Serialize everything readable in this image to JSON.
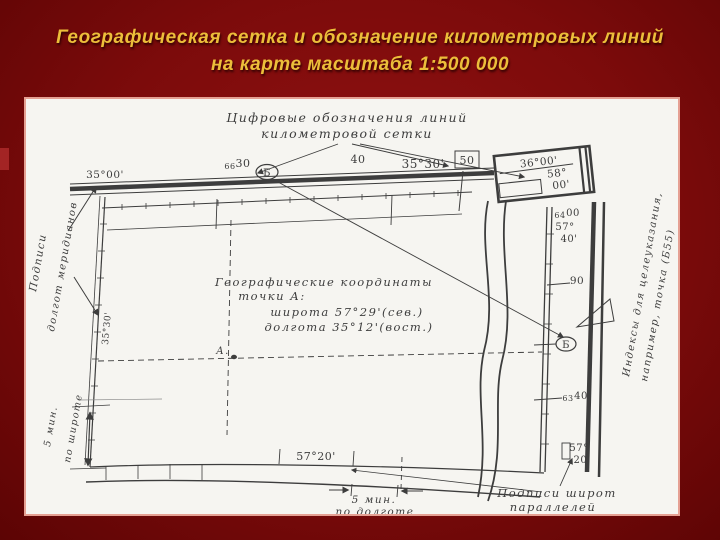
{
  "slide": {
    "title": {
      "line1": "Географическая сетка и обозначение километровых линий",
      "line2": "на карте масштаба 1:500 000"
    },
    "colors": {
      "background": "#7c0b0b",
      "title_text": "#ecbe3a",
      "panel_paper": "#f6f5f1",
      "panel_border": "#e5a093",
      "ink": "#3d3d3d"
    }
  },
  "diagram": {
    "top_caption": {
      "line1": "Цифровые обозначения линий",
      "line2": "километровой сетки"
    },
    "top_frame": {
      "corner_nw": "35°00'",
      "km_full_prefix": "66",
      "km_full": "30",
      "oval_letter": "Б",
      "km_40": "40",
      "meridian_mid": "35°30'",
      "km_50": "50"
    },
    "corner_ne": {
      "lon": "36°00'",
      "lat_deg": "58°",
      "lat_min": "00'"
    },
    "left_side": {
      "caption_line1": "Подписи",
      "caption_line2": "долгот меридианов",
      "meridian_vertical": "35°30'"
    },
    "coords_note": {
      "line1": "Географические координаты",
      "line2": "точки А:",
      "line3": "широта 57°29'(сев.)",
      "line4": "долгота 35°12'(вост.)"
    },
    "point_a": "А.",
    "right_side": {
      "km_6400_prefix": "64",
      "km_6400": "00",
      "lat_40_deg": "57°",
      "lat_40_min": "40'",
      "km_90": "90",
      "oval_letter": "Б",
      "km_6340_prefix": "63",
      "km_6340": "40",
      "lat_20_deg": "57°",
      "lat_20_min": "20'",
      "caption_line1": "Индексы для целеуказания,",
      "caption_line2": "например, точка (Б55)"
    },
    "bottom_side": {
      "parallel_label": "57°20'",
      "lon_extent_line1": "5 мин.",
      "lon_extent_line2": "по долготе",
      "lat_extent_line1": "5 мин.",
      "lat_extent_line2": "по широте",
      "caption_line1": "Подписи широт",
      "caption_line2": "параллелей"
    }
  }
}
